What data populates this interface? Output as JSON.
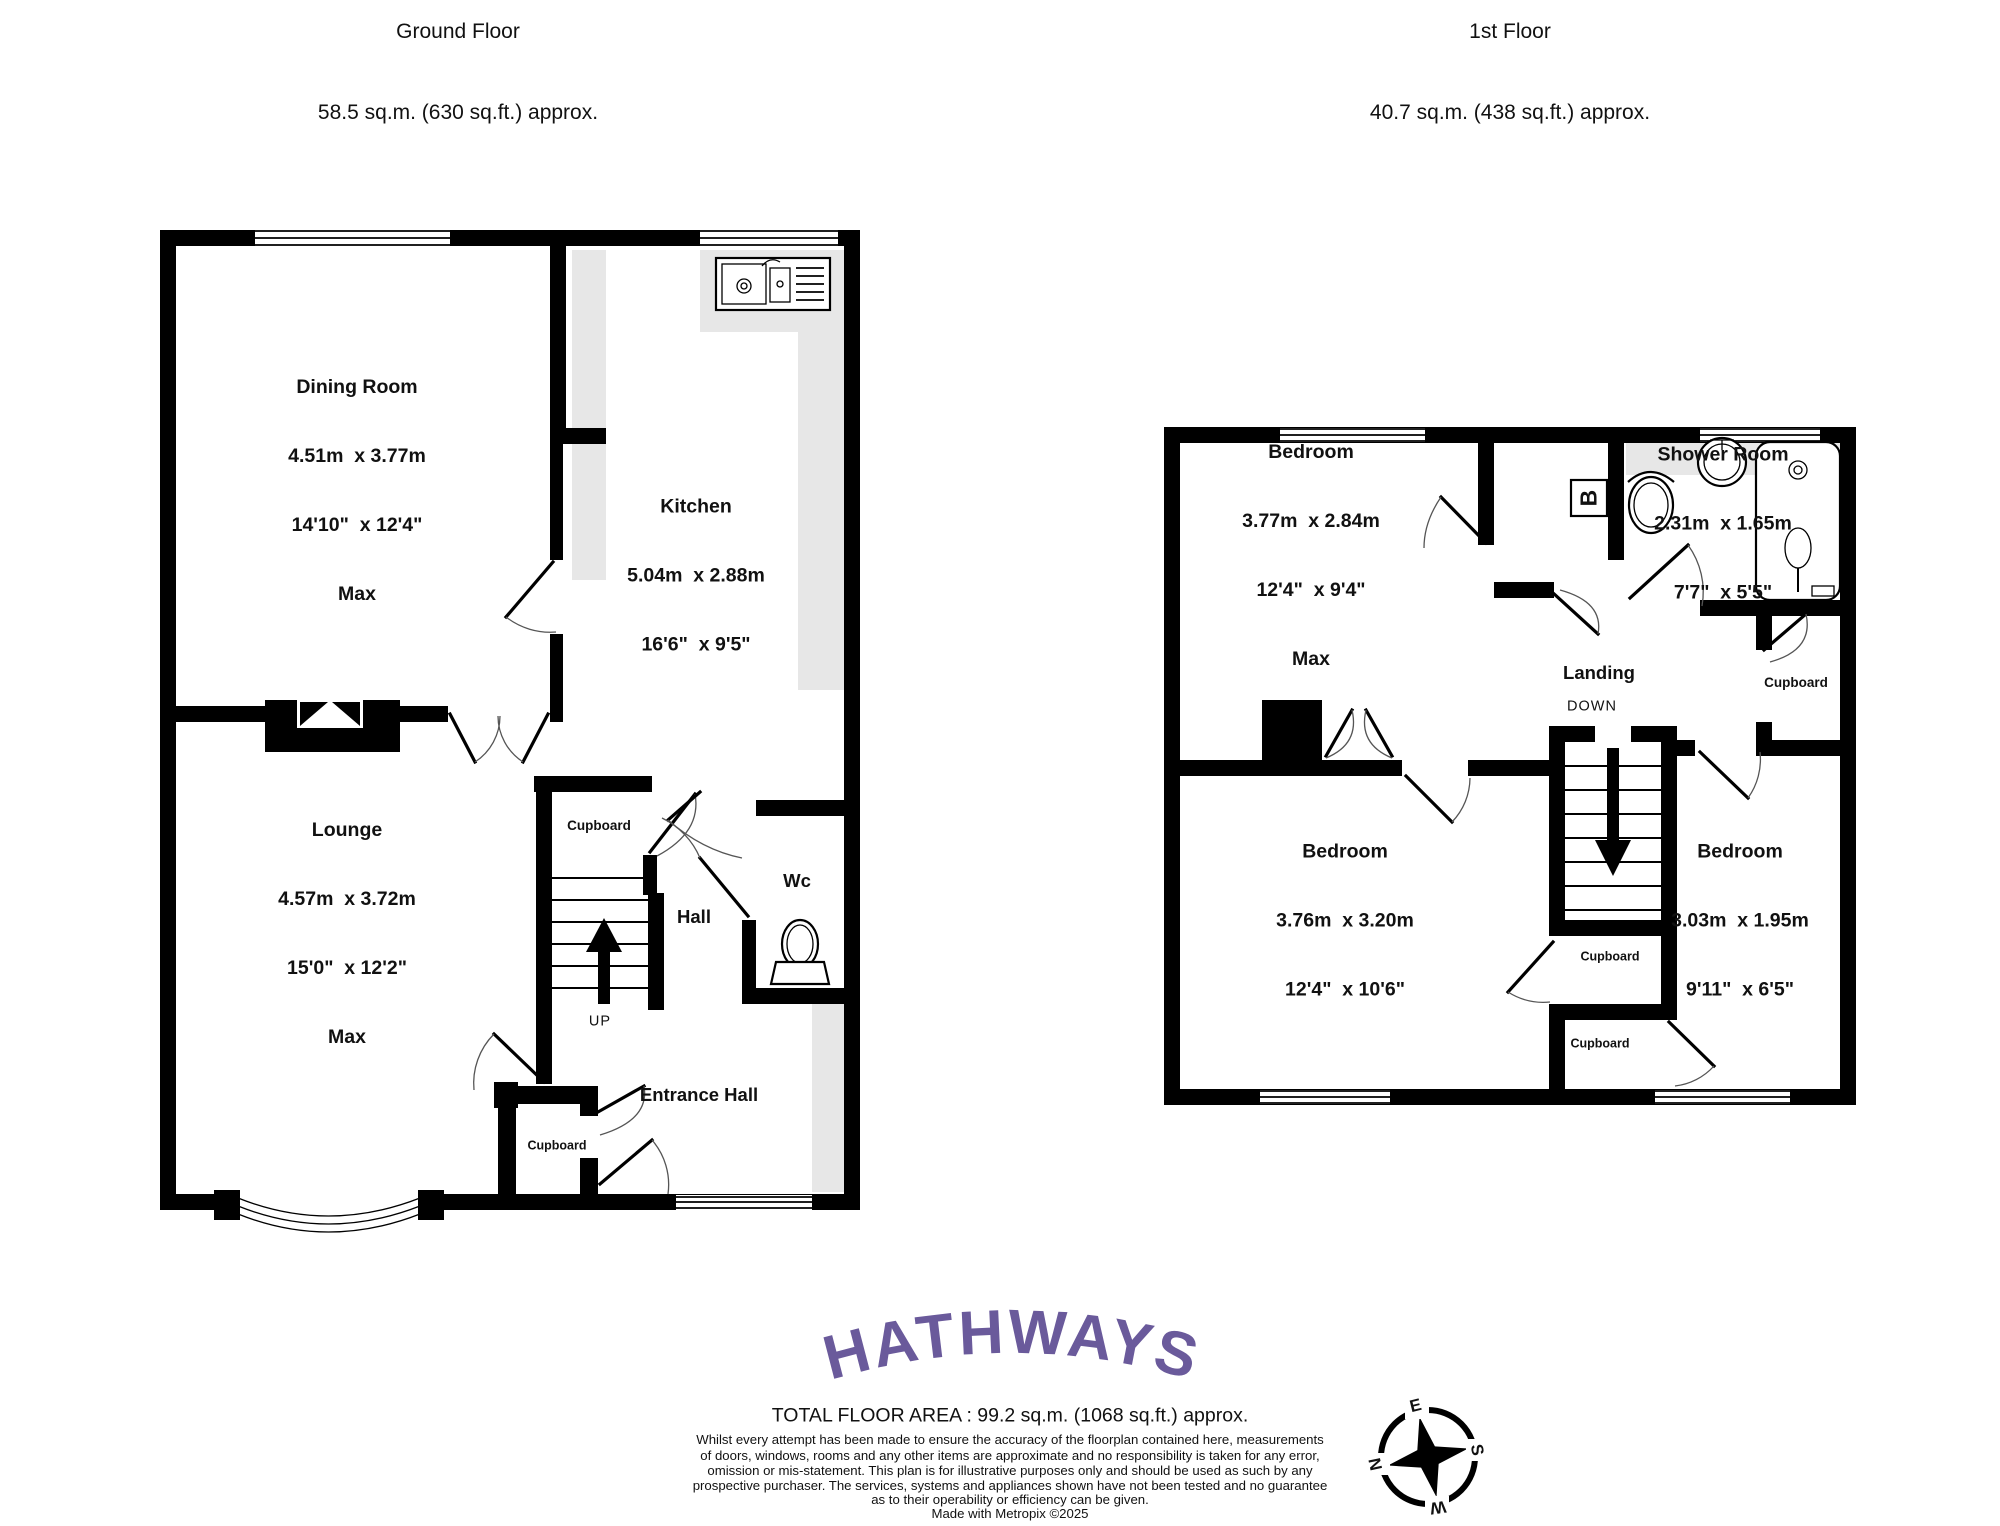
{
  "header": {
    "ground": {
      "line1": "Ground Floor",
      "line2": "58.5 sq.m. (630 sq.ft.) approx."
    },
    "first": {
      "line1": "1st Floor",
      "line2": "40.7 sq.m. (438 sq.ft.) approx."
    }
  },
  "ground_floor": {
    "dining_room": {
      "name": "Dining Room",
      "metric": "4.51m  x 3.77m",
      "imperial": "14'10\"  x 12'4\"",
      "note": "Max"
    },
    "kitchen": {
      "name": "Kitchen",
      "metric": "5.04m  x 2.88m",
      "imperial": "16'6\"  x 9'5\""
    },
    "lounge": {
      "name": "Lounge",
      "metric": "4.57m  x 3.72m",
      "imperial": "15'0\"  x 12'2\"",
      "note": "Max"
    },
    "cupboard_stairs": "Cupboard",
    "hall": "Hall",
    "wc": "Wc",
    "up": "UP",
    "entrance_hall": "Entrance Hall",
    "cupboard_entrance": "Cupboard"
  },
  "first_floor": {
    "bedroom_front": {
      "name": "Bedroom",
      "metric": "3.77m  x 2.84m",
      "imperial": "12'4\"  x 9'4\"",
      "note": "Max"
    },
    "shower_room": {
      "name": "Shower Room",
      "metric": "2.31m  x 1.65m",
      "imperial": "7'7\"  x 5'5\""
    },
    "boiler": "B",
    "landing": "Landing",
    "down": "DOWN",
    "cupboard_landing": "Cupboard",
    "bedroom_back": {
      "name": "Bedroom",
      "metric": "3.76m  x 3.20m",
      "imperial": "12'4\"  x 10'6\""
    },
    "bedroom_small": {
      "name": "Bedroom",
      "metric": "3.03m  x 1.95m",
      "imperial": "9'11\"  x 6'5\""
    },
    "cupboard_mid_upper": "Cupboard",
    "cupboard_mid_lower": "Cupboard"
  },
  "footer": {
    "logo": "HATHWAYS",
    "total_area": "TOTAL FLOOR AREA : 99.2 sq.m. (1068 sq.ft.) approx.",
    "disclaimer": [
      "Whilst every attempt has been made to ensure the accuracy of the floorplan contained here, measurements",
      "of doors, windows, rooms and any other items are approximate and no responsibility is taken for any error,",
      "omission or mis-statement. This plan is for illustrative purposes only and should be used as such by any",
      "prospective purchaser. The services, systems and appliances shown have not been tested and no guarantee",
      "as to their operability or efficiency can be given."
    ],
    "credit": "Made with Metropix ©2025",
    "compass": {
      "n": "N",
      "e": "E",
      "s": "S",
      "w": "W"
    }
  },
  "colors": {
    "wall": "#000000",
    "logo_purple": "#6a5a9b",
    "counter_grey": "#e7e7e7"
  }
}
